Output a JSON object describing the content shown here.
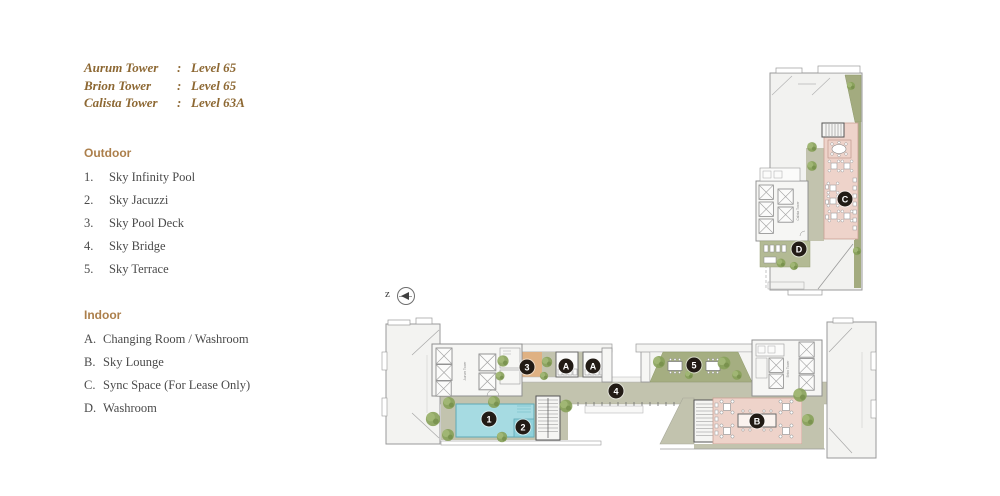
{
  "legend": {
    "towers": [
      {
        "name": "Aurum Tower",
        "colon": ":",
        "level": "Level 65"
      },
      {
        "name": "Brion Tower",
        "colon": ":",
        "level": "Level 65"
      },
      {
        "name": "Calista Tower",
        "colon": ":",
        "level": "Level 63A"
      }
    ],
    "outdoor": {
      "heading": "Outdoor",
      "items": [
        {
          "key": "1.",
          "label": "Sky Infinity Pool"
        },
        {
          "key": "2.",
          "label": "Sky Jacuzzi"
        },
        {
          "key": "3.",
          "label": "Sky Pool Deck"
        },
        {
          "key": "4.",
          "label": "Sky Bridge"
        },
        {
          "key": "5.",
          "label": "Sky Terrace"
        }
      ]
    },
    "indoor": {
      "heading": "Indoor",
      "items": [
        {
          "key": "A.",
          "label": "Changing Room / Washroom"
        },
        {
          "key": "B.",
          "label": "Sky Lounge"
        },
        {
          "key": "C.",
          "label": "Sync Space (For Lease Only)"
        },
        {
          "key": "D.",
          "label": "Washroom"
        }
      ]
    }
  },
  "compass": {
    "letter": "z"
  },
  "plan": {
    "tower_core_labels": [
      "Aurum Tower",
      "Brion Tower",
      "Calista Tower"
    ],
    "markers": [
      {
        "label": "1",
        "x": 489,
        "y": 419
      },
      {
        "label": "2",
        "x": 523,
        "y": 427
      },
      {
        "label": "3",
        "x": 527,
        "y": 367
      },
      {
        "label": "A",
        "x": 566,
        "y": 366
      },
      {
        "label": "A",
        "x": 593,
        "y": 366
      },
      {
        "label": "4",
        "x": 616,
        "y": 391
      },
      {
        "label": "5",
        "x": 694,
        "y": 365
      },
      {
        "label": "B",
        "x": 757,
        "y": 421
      },
      {
        "label": "C",
        "x": 845,
        "y": 199
      },
      {
        "label": "D",
        "x": 799,
        "y": 249
      }
    ],
    "colors": {
      "title_gold": "#8d6833",
      "heading_tan": "#ac7f4b",
      "body_text": "#4a4a4a",
      "walkway_olive": "#c2c3ae",
      "terrace_green": "#a5ae81",
      "washroom_green": "#b3ba94",
      "pool_blue": "#a6dbe2",
      "jacuzzi_blue": "#8ed0da",
      "deck_orange": "#dfb183",
      "lounge_pink": "#eed3ca",
      "marker_dark": "#221b15",
      "tree_green": "#87a159"
    }
  }
}
